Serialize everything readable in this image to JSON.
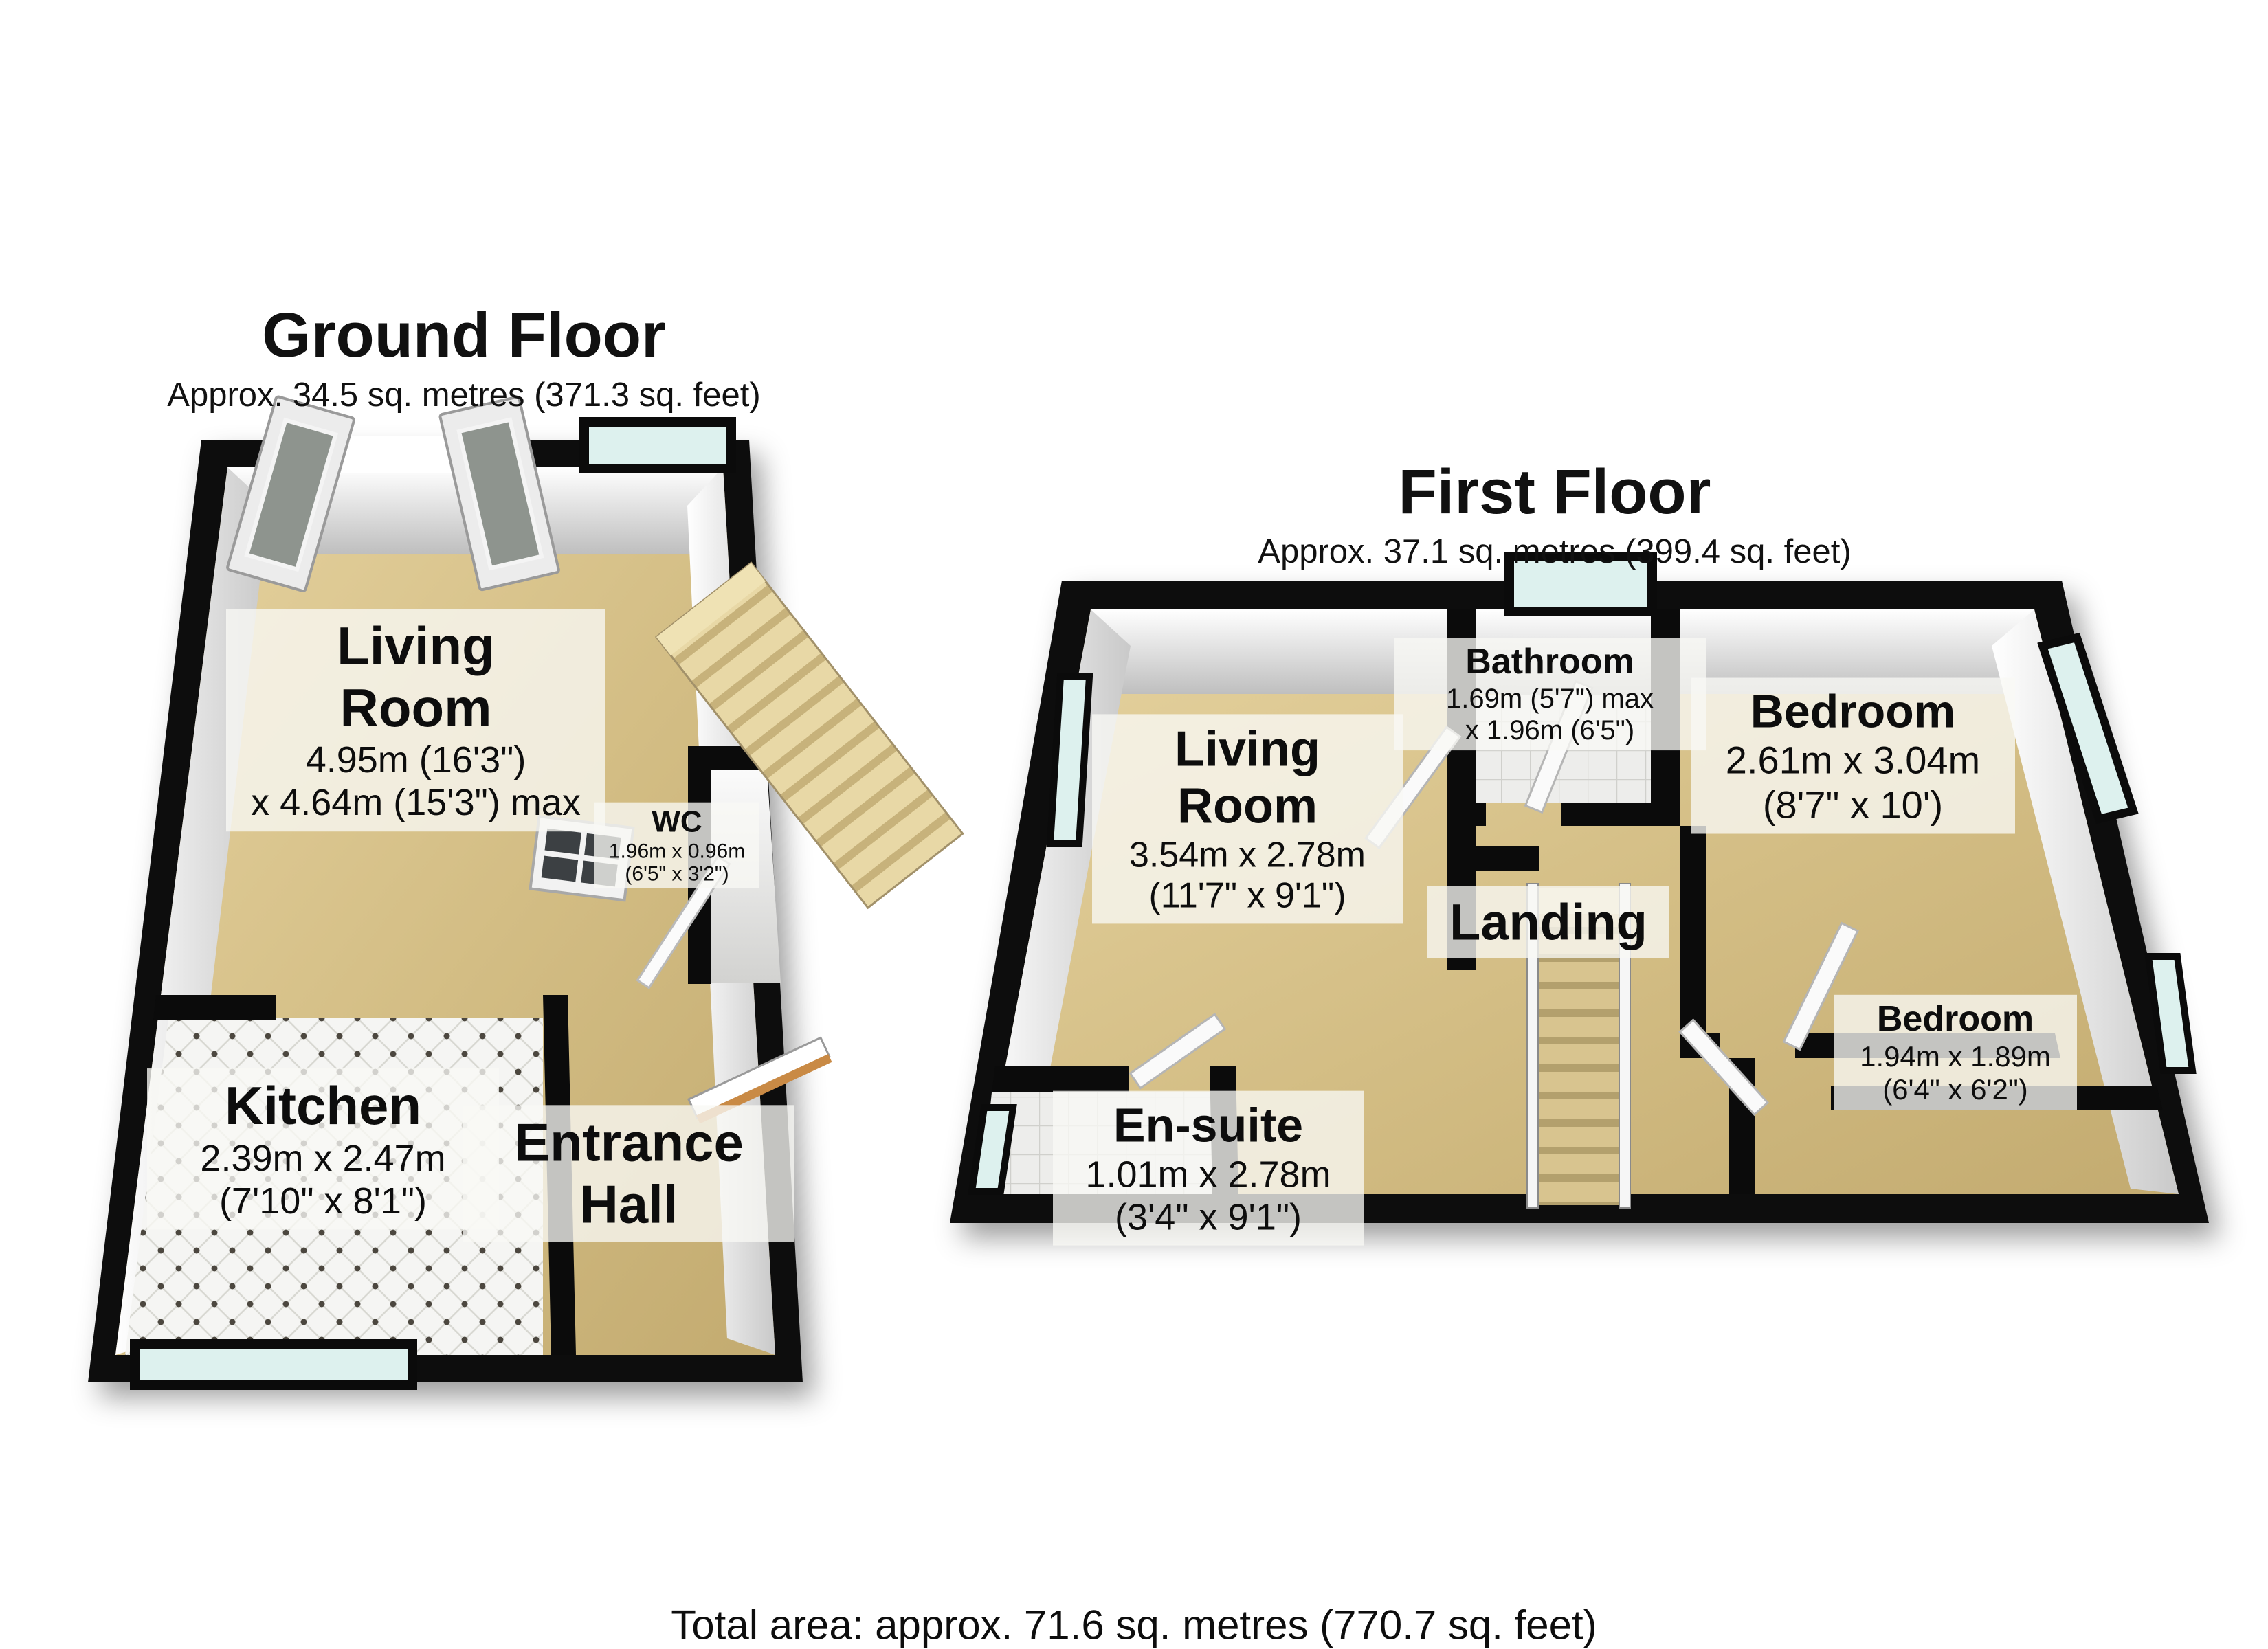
{
  "ground_floor": {
    "title": "Ground Floor",
    "area": "Approx. 34.5 sq. metres (371.3 sq. feet)",
    "rooms": {
      "living_room": {
        "name": "Living Room",
        "dim1": "4.95m (16'3\")",
        "dim2": "x 4.64m (15'3\") max"
      },
      "wc": {
        "name": "WC",
        "dim1": "1.96m x 0.96m",
        "dim2": "(6'5\" x 3'2\")"
      },
      "kitchen": {
        "name": "Kitchen",
        "dim1": "2.39m x 2.47m",
        "dim2": "(7'10\" x 8'1\")"
      },
      "entrance_hall": {
        "name": "Entrance Hall"
      }
    }
  },
  "first_floor": {
    "title": "First Floor",
    "area": "Approx. 37.1 sq. metres (399.4 sq. feet)",
    "rooms": {
      "living_room": {
        "name": "Living Room",
        "dim1": "3.54m x 2.78m",
        "dim2": "(11'7\" x 9'1\")"
      },
      "bathroom": {
        "name": "Bathroom",
        "dim1": "1.69m (5'7\") max",
        "dim2": "x 1.96m (6'5\")"
      },
      "bedroom1": {
        "name": "Bedroom",
        "dim1": "2.61m x 3.04m",
        "dim2": "(8'7\" x 10')"
      },
      "landing": {
        "name": "Landing"
      },
      "ensuite": {
        "name": "En-suite",
        "dim1": "1.01m x 2.78m",
        "dim2": "(3'4\" x 9'1\")"
      },
      "bedroom2": {
        "name": "Bedroom",
        "dim1": "1.94m x 1.89m",
        "dim2": "(6'4\" x 6'2\")"
      }
    }
  },
  "total_area": "Total area: approx. 71.6 sq. metres (770.7 sq. feet)",
  "colors": {
    "wall": "#0b0b0b",
    "floor_tan": "#d3bd84",
    "tile_white": "#f4f4f2",
    "window_glass": "#ddf1ee",
    "label_background": "rgba(248,248,245,0.78)"
  }
}
